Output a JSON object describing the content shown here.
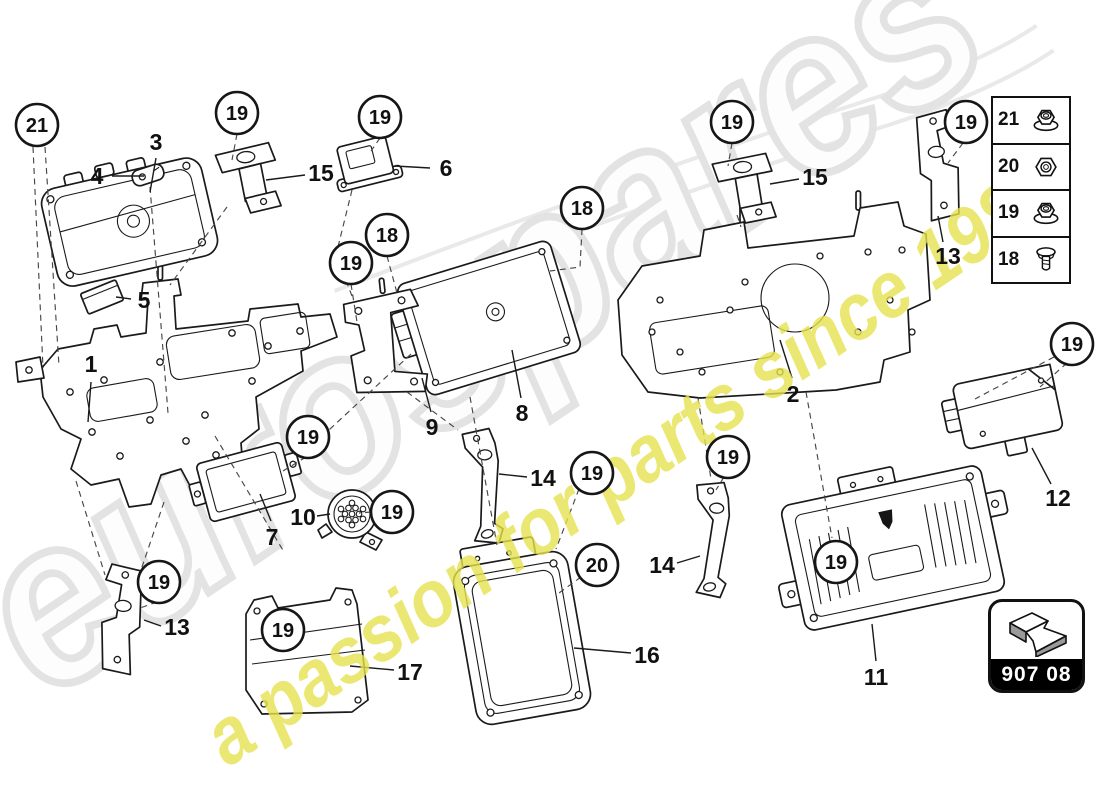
{
  "watermark": {
    "brand_text": "eurospares",
    "tagline_text": "a passion for parts since 1985",
    "brand_color": "#e3e3e3",
    "tagline_color": "#e6e24f"
  },
  "page_code": {
    "label": "907 08"
  },
  "legend": {
    "items": [
      {
        "label": "21",
        "icon": "flange-nut-icon"
      },
      {
        "label": "20",
        "icon": "hex-nut-icon"
      },
      {
        "label": "19",
        "icon": "flange-nut-icon"
      },
      {
        "label": "18",
        "icon": "screw-icon"
      }
    ]
  },
  "diagram": {
    "callouts": [
      {
        "label": "21",
        "x": 37,
        "y": 125
      },
      {
        "label": "19",
        "x": 237,
        "y": 113
      },
      {
        "label": "19",
        "x": 380,
        "y": 117
      },
      {
        "label": "18",
        "x": 582,
        "y": 208
      },
      {
        "label": "19",
        "x": 732,
        "y": 122
      },
      {
        "label": "19",
        "x": 966,
        "y": 122
      },
      {
        "label": "18",
        "x": 387,
        "y": 235
      },
      {
        "label": "19",
        "x": 351,
        "y": 263
      },
      {
        "label": "19",
        "x": 308,
        "y": 437
      },
      {
        "label": "19",
        "x": 392,
        "y": 512
      },
      {
        "label": "19",
        "x": 592,
        "y": 473
      },
      {
        "label": "20",
        "x": 597,
        "y": 565
      },
      {
        "label": "19",
        "x": 728,
        "y": 457
      },
      {
        "label": "19",
        "x": 159,
        "y": 582
      },
      {
        "label": "19",
        "x": 283,
        "y": 630
      },
      {
        "label": "19",
        "x": 836,
        "y": 562
      },
      {
        "label": "19",
        "x": 1072,
        "y": 344
      }
    ],
    "part_labels": [
      {
        "label": "3",
        "x": 156,
        "y": 142
      },
      {
        "label": "4",
        "x": 97,
        "y": 176
      },
      {
        "label": "15",
        "x": 321,
        "y": 173
      },
      {
        "label": "6",
        "x": 446,
        "y": 168
      },
      {
        "label": "15",
        "x": 815,
        "y": 177
      },
      {
        "label": "13",
        "x": 948,
        "y": 256
      },
      {
        "label": "5",
        "x": 144,
        "y": 300
      },
      {
        "label": "1",
        "x": 91,
        "y": 364
      },
      {
        "label": "2",
        "x": 793,
        "y": 394
      },
      {
        "label": "8",
        "x": 522,
        "y": 413
      },
      {
        "label": "9",
        "x": 432,
        "y": 427
      },
      {
        "label": "14",
        "x": 543,
        "y": 478
      },
      {
        "label": "10",
        "x": 303,
        "y": 517
      },
      {
        "label": "7",
        "x": 272,
        "y": 537
      },
      {
        "label": "12",
        "x": 1058,
        "y": 498
      },
      {
        "label": "14",
        "x": 662,
        "y": 565
      },
      {
        "label": "13",
        "x": 177,
        "y": 627
      },
      {
        "label": "17",
        "x": 410,
        "y": 672
      },
      {
        "label": "16",
        "x": 647,
        "y": 655
      },
      {
        "label": "11",
        "x": 876,
        "y": 677
      }
    ]
  }
}
